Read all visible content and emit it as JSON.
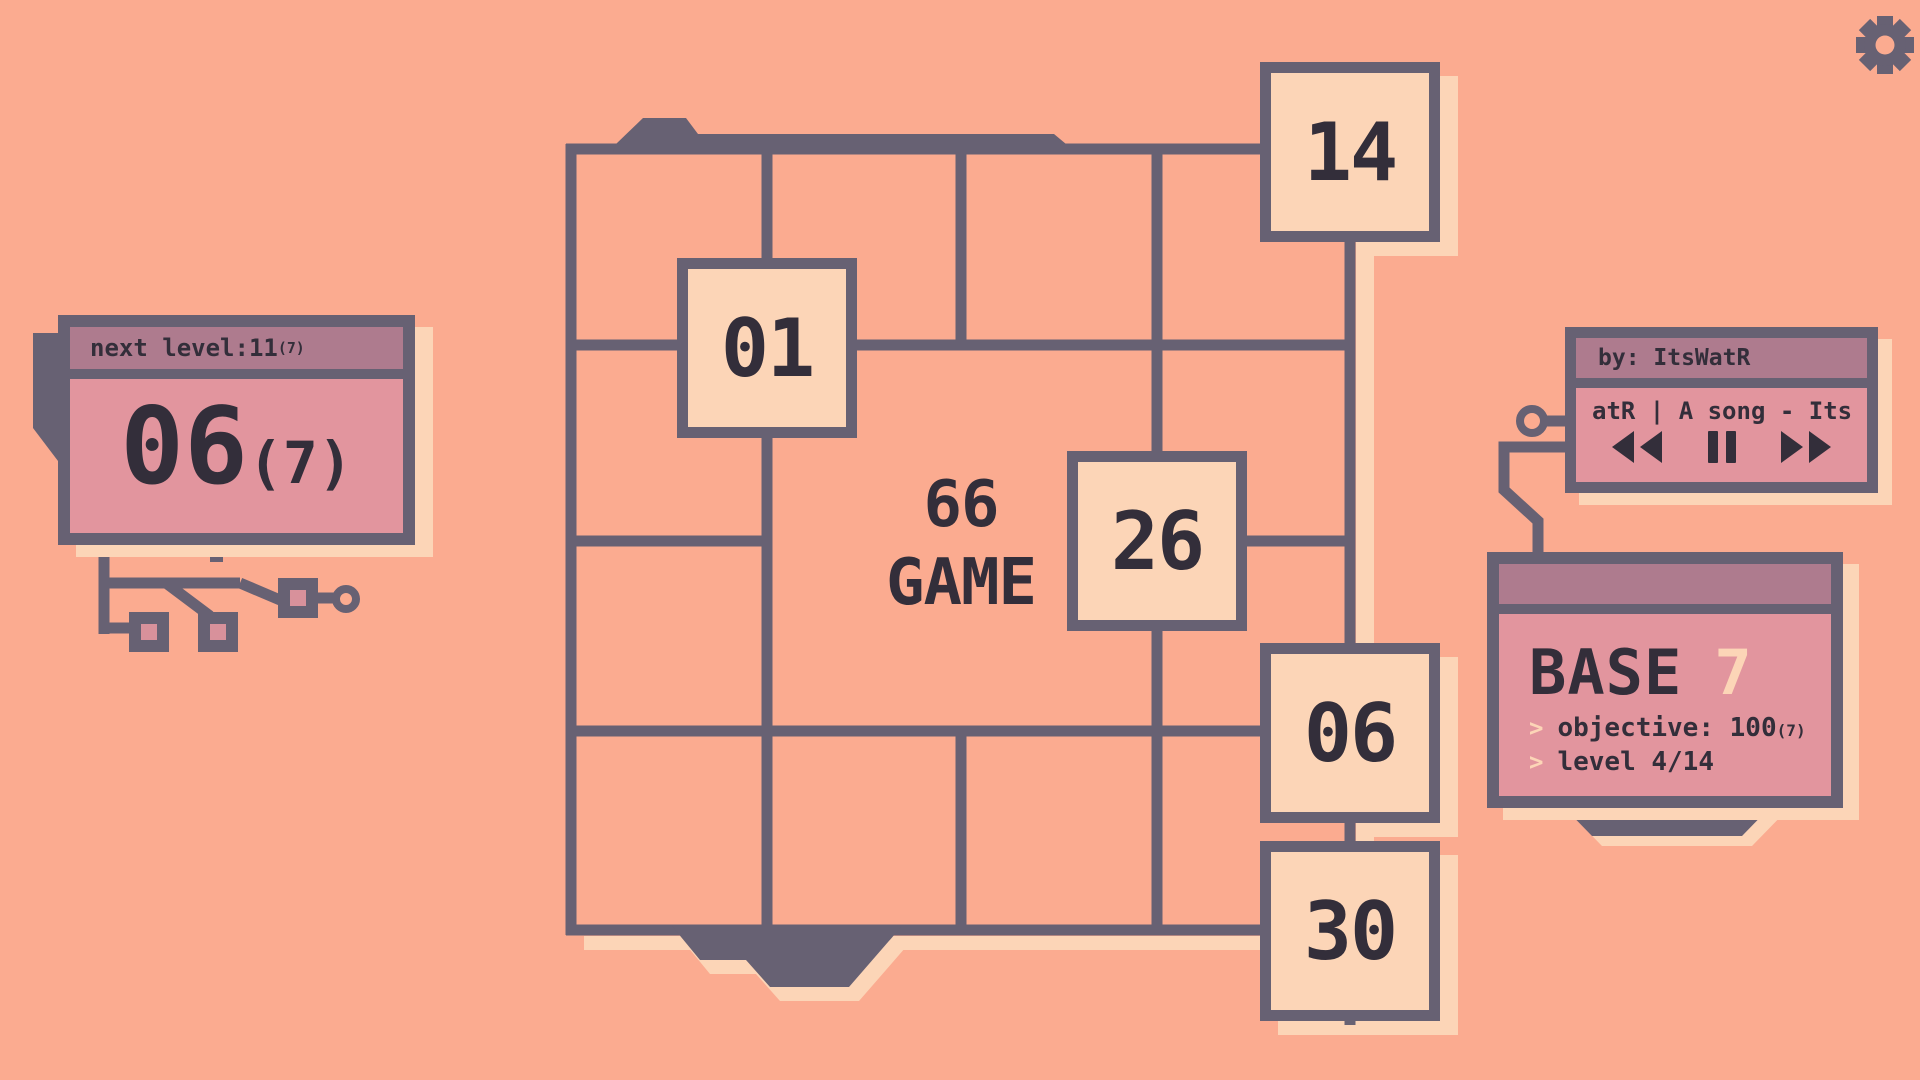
{
  "window": {
    "title": "66 GAME"
  },
  "header": {
    "gear_icon": "gear"
  },
  "next_level_panel": {
    "label": "next level: ",
    "value": "11",
    "value_base": "(7)",
    "current": "06",
    "current_base": "(7)"
  },
  "board": {
    "logo_line1": "66",
    "logo_line2": "GAME",
    "tiles": [
      {
        "label": "14"
      },
      {
        "label": "01"
      },
      {
        "label": "26"
      },
      {
        "label": "06"
      },
      {
        "label": "30"
      }
    ]
  },
  "music_player": {
    "by_label": "by: ItsWatR",
    "song_title": "atR | A song - Its",
    "controls": {
      "rewind_icon": "rewind",
      "pause_icon": "pause",
      "forward_icon": "fast-forward"
    }
  },
  "base_panel": {
    "title": "BASE",
    "base_value": "7",
    "prompt_char": ">",
    "objective_label": "objective: 100",
    "objective_base": "(7)",
    "level_label": "level 4/14"
  },
  "colors": {
    "background": "#fbab90",
    "slate_lines": "#676173",
    "text_dark": "#332e3a",
    "header_mauve": "#ae7b8e",
    "panel_pink": "#e2959e",
    "cream": "#fcd5b7",
    "pad_pink": "#d8919b"
  }
}
